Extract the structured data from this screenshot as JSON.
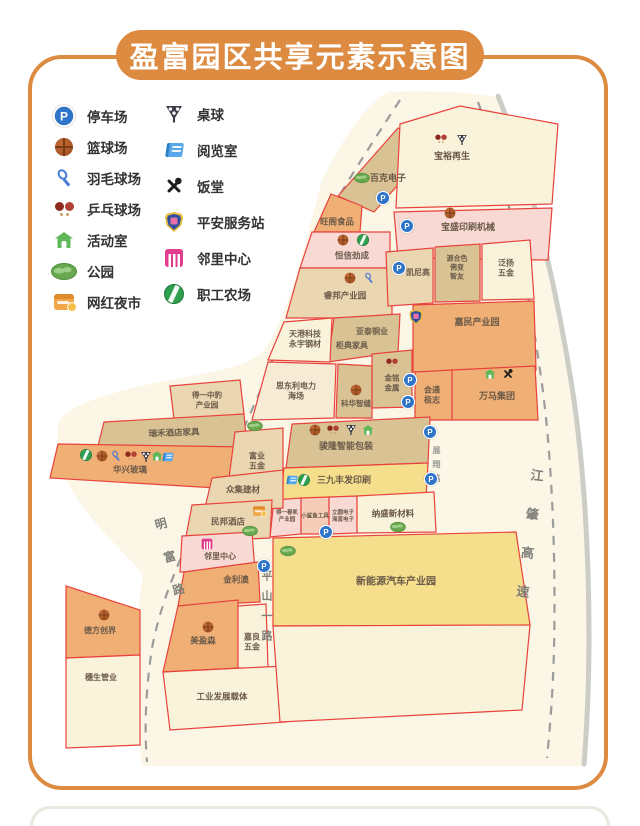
{
  "title": "盈富园区共享元素示意图",
  "colors": {
    "accent_orange": "#DC8B41",
    "parcel_stroke": "#E8423C",
    "parcel_cream": "#FAF3DB",
    "parcel_tan": "#D9C394",
    "parcel_light_tan": "#EBD6B2",
    "parcel_orange": "#F0AF74",
    "parcel_pink": "#F8D9D4",
    "parcel_yellow": "#F6DF8C",
    "map_background": "#FBF6E5",
    "parking_blue": "#2E74C8"
  },
  "legend": {
    "col1": [
      {
        "icon": "parking-icon",
        "label": "停车场"
      },
      {
        "icon": "basketball-icon",
        "label": "篮球场"
      },
      {
        "icon": "badminton-icon",
        "label": "羽毛球场"
      },
      {
        "icon": "pingpong-icon",
        "label": "乒乓球场"
      },
      {
        "icon": "activity-house-icon",
        "label": "活动室"
      },
      {
        "icon": "park-icon",
        "label": "公园"
      },
      {
        "icon": "night-market-icon",
        "label": "网红夜市"
      }
    ],
    "col2": [
      {
        "icon": "billiards-icon",
        "label": "桌球"
      },
      {
        "icon": "reading-room-icon",
        "label": "阅览室"
      },
      {
        "icon": "canteen-icon",
        "label": "饭堂"
      },
      {
        "icon": "safety-station-icon",
        "label": "平安服务站"
      },
      {
        "icon": "neighborhood-center-icon",
        "label": "邻里中心"
      },
      {
        "icon": "staff-farm-icon",
        "label": "职工农场"
      }
    ]
  },
  "roads": {
    "mingfu": "明富路",
    "pingshan": "平山一路",
    "jiangzhao": "江肇高速",
    "zhanxiang": "展翔路"
  },
  "blocks": {
    "baike": {
      "name": "百克电子"
    },
    "baoyu": {
      "name": "宝裕再生"
    },
    "baosheng": {
      "name": "宝盛印刷机械"
    },
    "wangge": {
      "name": "旺阁食品"
    },
    "hengxin": {
      "name": "恒信劲成"
    },
    "ruibang": {
      "name": "睿邦产业园"
    },
    "kainigao": {
      "name": "凯尼高"
    },
    "yuanhese": {
      "lines": [
        "源合色",
        "佛变",
        "智友"
      ]
    },
    "fanyang": {
      "lines": [
        "泛扬",
        "五金"
      ]
    },
    "jiamin": {
      "name": "嘉民产业园"
    },
    "yatai": {
      "name": "亚泰铜业"
    },
    "guidian": {
      "name": "柜典家具"
    },
    "tianyuan": {
      "lines": [
        "天港科技",
        "永宇钢材"
      ]
    },
    "sidongli": {
      "lines": [
        "思东利电力",
        "海场"
      ]
    },
    "kehua": {
      "name": "科华智缝"
    },
    "jinming": {
      "lines": [
        "金铭",
        "金属"
      ]
    },
    "huitong": {
      "lines": [
        "会通",
        "极志"
      ]
    },
    "wanma": {
      "name": "万马集团"
    },
    "junlong": {
      "name": "骏隆智能包装"
    },
    "sanjiu": {
      "name": "三九丰发印刷"
    },
    "deyichunkai": {
      "lines": [
        "得一春凯",
        "产业园"
      ]
    },
    "xiaoshayu": {
      "name": "小鲨鱼工具"
    },
    "liyuan": {
      "lines": [
        "立圆电子",
        "海富电子"
      ]
    },
    "nasheng": {
      "name": "纳盛新材料"
    },
    "deyizhongbao": {
      "lines": [
        "得一中豹",
        "产业园"
      ]
    },
    "ruihe": {
      "name": "瑞禾酒店家具"
    },
    "huaxing": {
      "name": "华兴玻璃"
    },
    "fuye": {
      "lines": [
        "富业",
        "五金"
      ]
    },
    "zhongji": {
      "name": "众集建材"
    },
    "minbang": {
      "name": "民邦酒店"
    },
    "linli": {
      "name": "邻里中心"
    },
    "jinliao": {
      "name": "金利澳"
    },
    "meiyingsen": {
      "name": "美盈森"
    },
    "jialiang": {
      "lines": [
        "嘉良",
        "五金"
      ]
    },
    "gongye": {
      "name": "工业发展载体"
    },
    "defang": {
      "name": "德方创界"
    },
    "suisheng": {
      "name": "穗生管业"
    },
    "xinnengyuan": {
      "name": "新能源汽车产业园"
    }
  }
}
